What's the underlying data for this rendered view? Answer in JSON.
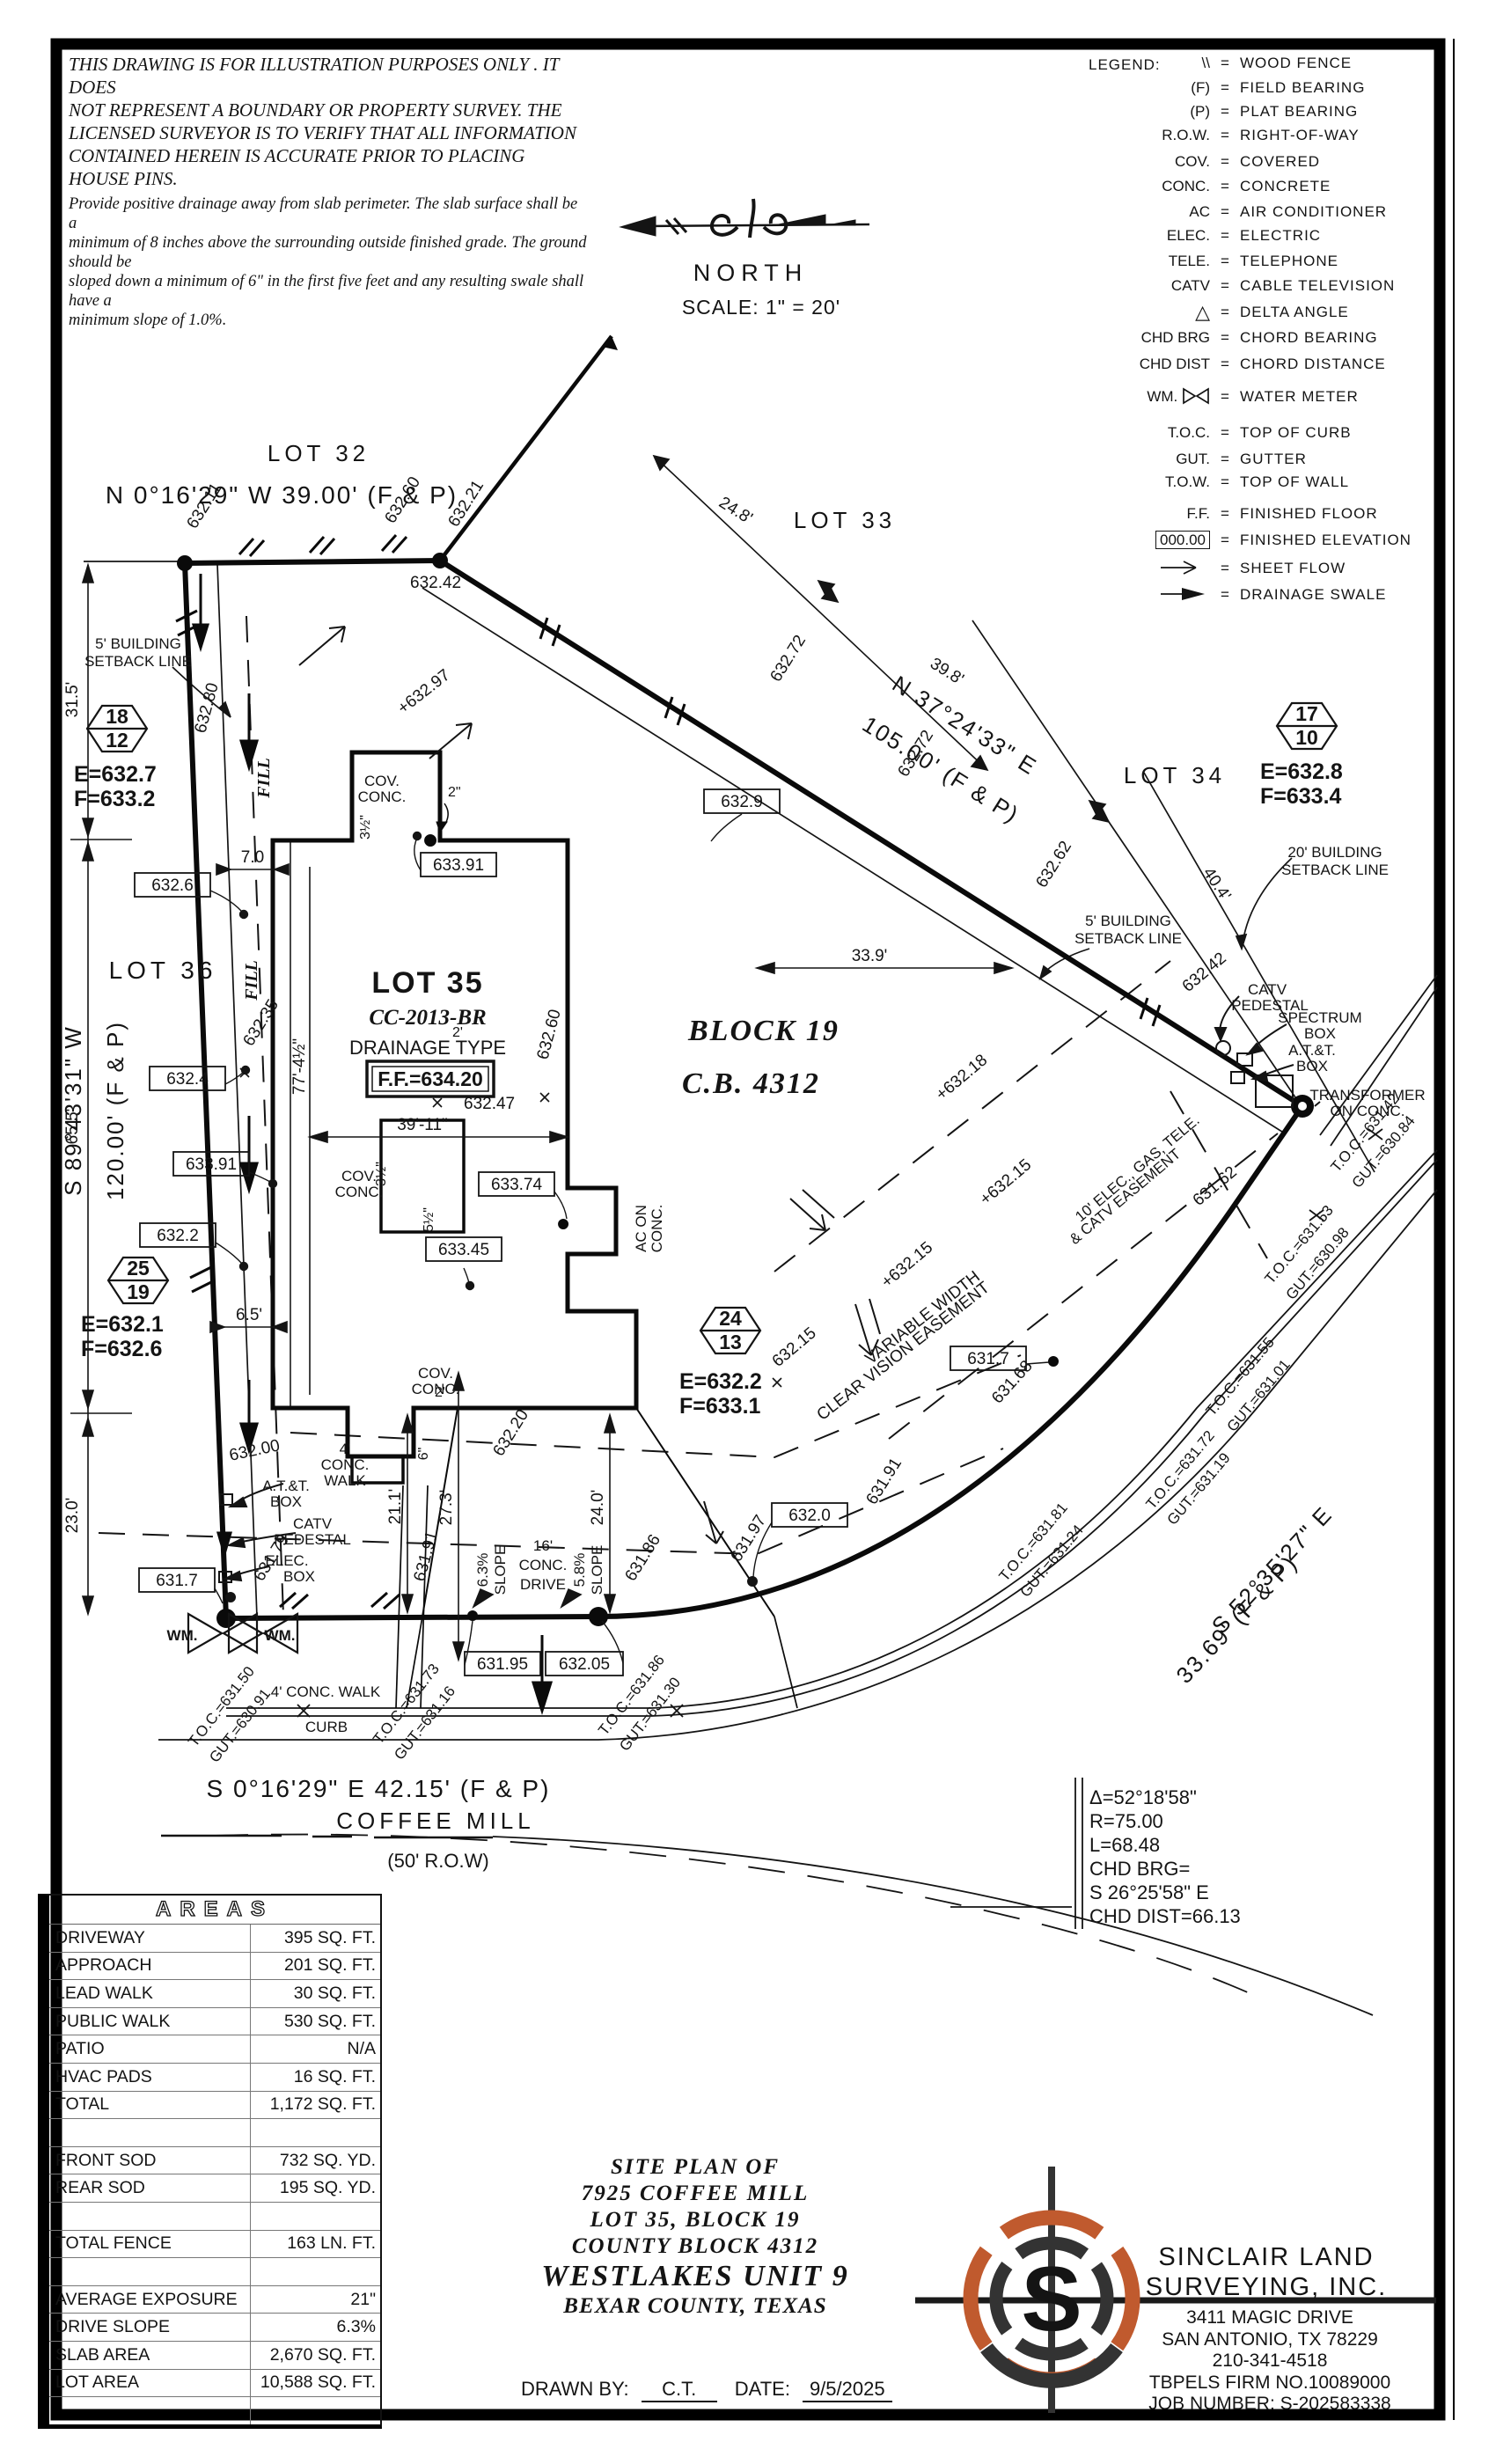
{
  "disclaimer": {
    "p1": [
      "THIS DRAWING IS FOR ILLUSTRATION PURPOSES ONLY . IT DOES",
      "NOT REPRESENT A BOUNDARY OR PROPERTY SURVEY. THE",
      "LICENSED SURVEYOR IS TO VERIFY THAT ALL INFORMATION",
      "CONTAINED HEREIN IS ACCURATE PRIOR TO PLACING HOUSE PINS."
    ],
    "p2": [
      "Provide positive drainage away from slab perimeter. The slab surface shall be a",
      "minimum of 8 inches above the surrounding outside finished grade. The ground should be",
      "sloped down a minimum of 6\" in the first five feet and any resulting swale shall have a",
      "minimum slope of 1.0%."
    ]
  },
  "north": {
    "label": "NORTH",
    "scale": "SCALE: 1\" = 20'"
  },
  "legend": {
    "title": "LEGEND:",
    "items": [
      {
        "sym": "\\\\",
        "desc": "WOOD FENCE"
      },
      {
        "sym": "(F)",
        "desc": "FIELD BEARING"
      },
      {
        "sym": "(P)",
        "desc": "PLAT BEARING"
      },
      {
        "sym": "R.O.W.",
        "desc": "RIGHT-OF-WAY"
      },
      {
        "sym": "COV.",
        "desc": "COVERED"
      },
      {
        "sym": "CONC.",
        "desc": "CONCRETE"
      },
      {
        "sym": "AC",
        "desc": "AIR CONDITIONER"
      },
      {
        "sym": "ELEC.",
        "desc": "ELECTRIC"
      },
      {
        "sym": "TELE.",
        "desc": "TELEPHONE"
      },
      {
        "sym": "CATV",
        "desc": "CABLE TELEVISION"
      },
      {
        "sym": "△",
        "desc": "DELTA ANGLE"
      },
      {
        "sym": "CHD BRG",
        "desc": "CHORD BEARING"
      },
      {
        "sym": "CHD DIST",
        "desc": "CHORD DISTANCE"
      },
      {
        "sym": "WM.",
        "desc": "WATER METER"
      },
      {
        "sym": "T.O.C.",
        "desc": "TOP OF CURB"
      },
      {
        "sym": "GUT.",
        "desc": "GUTTER"
      },
      {
        "sym": "T.O.W.",
        "desc": "TOP OF WALL"
      },
      {
        "sym": "F.F.",
        "desc": "FINISHED FLOOR"
      },
      {
        "sym": "000.00",
        "desc": "FINISHED ELEVATION"
      },
      {
        "sym": "",
        "desc": "SHEET FLOW"
      },
      {
        "sym": "",
        "desc": "DRAINAGE SWALE"
      }
    ]
  },
  "plat": {
    "bearings": {
      "top": "N 0°16'29\" W 39.00' (F & P)",
      "diag1": "N 37°24'33\" E",
      "diag2": "105.00' (F & P)",
      "left1": "S 89°43'31\" W",
      "left2": "120.00' (F & P)",
      "bottom": "S 0°16'29\" E 42.15' (F & P)",
      "curve1": "S 52°35'27\" E",
      "curve2": "33.69' (F & P)"
    },
    "lots": {
      "l32": "LOT 32",
      "l33": "LOT 33",
      "l34": "LOT 34",
      "l35": "LOT 35",
      "l36": "LOT 36",
      "block": "BLOCK 19",
      "cb": "C.B. 4312"
    },
    "house": {
      "plan": "CC-2013-BR",
      "drainage": "DRAINAGE TYPE",
      "ff": "F.F.=634.20",
      "width": "39'-11\"",
      "height": "77'-4½\"",
      "cov": "COV.",
      "conc": "CONC.",
      "ac1": "AC ON",
      "ac2": "CONC."
    },
    "street": {
      "name": "COFFEE MILL",
      "row": "(50' R.O.W)"
    },
    "curve": {
      "delta": "Δ=52°18'58\"",
      "r": "R=75.00",
      "len": "L=68.48",
      "chd": "CHD BRG=",
      "chd_brg": "S 26°25'58\" E",
      "chd_dist": "CHD DIST=66.13"
    },
    "monuments": [
      {
        "top": "18",
        "bot": "12",
        "e": "E=632.7",
        "f": "F=633.2"
      },
      {
        "top": "17",
        "bot": "10",
        "e": "E=632.8",
        "f": "F=633.4"
      },
      {
        "top": "25",
        "bot": "19",
        "e": "E=632.1",
        "f": "F=632.6"
      },
      {
        "top": "24",
        "bot": "13",
        "e": "E=632.2",
        "f": "F=633.1"
      }
    ],
    "boxed": [
      "633.91",
      "632.6",
      "632.9",
      "632.4",
      "633.91",
      "632.2",
      "633.74",
      "633.45",
      "631.7",
      "631.7",
      "632.0",
      "631.95",
      "632.05"
    ],
    "spots": [
      "632.11",
      "632.60",
      "632.21",
      "632.42",
      "632.72",
      "632.72",
      "+632.97",
      "632.80",
      "632.35",
      "632.60",
      "632.62",
      "632.42",
      "631.62",
      "+632.18",
      "+632.15",
      "+632.15",
      "632.15",
      "631.68",
      "631.91",
      "631.97",
      "631.86",
      "631.91",
      "631.79",
      "632.00",
      "632.20",
      "632.47"
    ],
    "toc": [
      {
        "toc": "T.O.C.=631.50",
        "gut": "GUT.=630.91"
      },
      {
        "toc": "T.O.C.=631.73",
        "gut": "GUT.=631.16"
      },
      {
        "toc": "T.O.C.=631.86",
        "gut": "GUT.=631.30"
      },
      {
        "toc": "T.O.C.=631.81",
        "gut": "GUT.=631.24"
      },
      {
        "toc": "T.O.C.=631.72",
        "gut": "GUT.=631.19"
      },
      {
        "toc": "T.O.C.=631.55",
        "gut": "GUT.=631.01"
      },
      {
        "toc": "T.O.C.=631.53",
        "gut": "GUT.=630.98"
      },
      {
        "toc": "T.O.C.=631.42",
        "gut": "GUT.=630.84"
      }
    ],
    "dims": {
      "d315": "31.5'",
      "d655": "65.5'",
      "d230": "23.0'",
      "d70": "7.0",
      "d65": "6.5'",
      "d248": "24.8'",
      "d398": "39.8'",
      "d404": "40.4'",
      "d339": "33.9'",
      "d211": "21.1'",
      "d273": "27.3'",
      "d240": "24.0'",
      "w2a": "2\"",
      "w2b": "2'",
      "w2c": "2\"",
      "w3": "3½\"",
      "w5": "5½\"",
      "w6": "6\""
    },
    "ann": {
      "sb5": "5' BUILDING",
      "sb20": "20' BUILDING",
      "sbl": "SETBACK LINE",
      "fill": "FILL",
      "att": "A.T.&T.",
      "box": "BOX",
      "catv": "CATV",
      "ped": "PEDESTAL",
      "elec": "ELEC.",
      "spec": "SPECTRUM",
      "trans1": "TRANSFORMER",
      "trans2": "ON CONC.",
      "w4a": "4'",
      "wconc": "CONC.",
      "wwalk": "WALK",
      "walk4": "4' CONC. WALK",
      "curb": "CURB",
      "wm": "WM.",
      "dr1": "16'",
      "dr2": "CONC.",
      "dr3": "DRIVE",
      "s63": "6.3%",
      "s58": "5.8%",
      "slope": "SLOPE",
      "vw1": "VARIABLE WIDTH",
      "vw2": "CLEAR VISION EASEMENT",
      "ez1": "10' ELEC., GAS, TELE.",
      "ez2": "& CATV EASEMENT"
    }
  },
  "table": {
    "title": "AREAS",
    "rows": [
      {
        "l": "DRIVEWAY",
        "v": "395 SQ. FT."
      },
      {
        "l": "APPROACH",
        "v": "201 SQ. FT."
      },
      {
        "l": "LEAD WALK",
        "v": "30 SQ. FT."
      },
      {
        "l": "PUBLIC WALK",
        "v": "530 SQ. FT."
      },
      {
        "l": "PATIO",
        "v": "N/A"
      },
      {
        "l": "HVAC PADS",
        "v": "16 SQ. FT."
      },
      {
        "l": "TOTAL",
        "v": "1,172 SQ. FT."
      },
      {
        "l": "",
        "v": ""
      },
      {
        "l": "FRONT SOD",
        "v": "732 SQ. YD."
      },
      {
        "l": "REAR SOD",
        "v": "195 SQ. YD."
      },
      {
        "l": "",
        "v": ""
      },
      {
        "l": "TOTAL FENCE",
        "v": "163 LN. FT."
      },
      {
        "l": "",
        "v": ""
      },
      {
        "l": "AVERAGE EXPOSURE",
        "v": "21\""
      },
      {
        "l": "DRIVE SLOPE",
        "v": "6.3%"
      },
      {
        "l": "SLAB AREA",
        "v": "2,670 SQ. FT."
      },
      {
        "l": "LOT AREA",
        "v": "10,588 SQ. FT."
      },
      {
        "l": "",
        "v": ""
      }
    ]
  },
  "title": {
    "l1": "SITE PLAN OF",
    "l2": "7925 COFFEE MILL",
    "l3": "LOT 35, BLOCK 19",
    "l4": "COUNTY BLOCK 4312",
    "l5": "WESTLAKES UNIT 9",
    "l6": "BEXAR COUNTY, TEXAS",
    "drawn_label": "DRAWN BY:",
    "drawn": "C.T.",
    "date_label": "DATE:",
    "date": "9/5/2025"
  },
  "company": {
    "n1": "SINCLAIR LAND",
    "n2": "SURVEYING, INC.",
    "a1": "3411 MAGIC DRIVE",
    "a2": "SAN ANTONIO, TX 78229",
    "phone": "210-341-4518",
    "firm": "TBPELS FIRM NO.10089000",
    "job": "JOB NUMBER: S-202583338",
    "logo_orange": "#c05a2e",
    "logo_dark": "#333333"
  }
}
